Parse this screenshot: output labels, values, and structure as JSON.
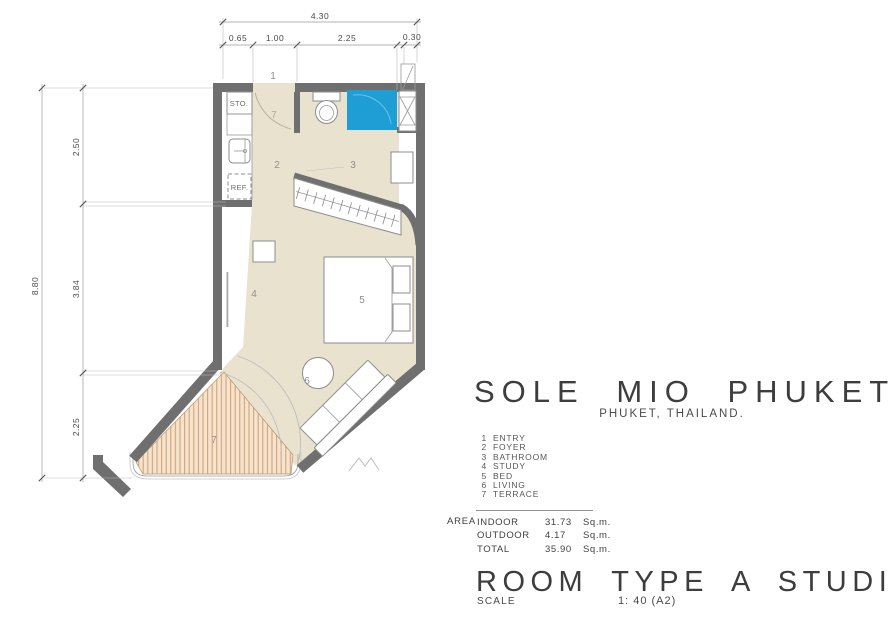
{
  "title": "SOLE MIO PHUKET",
  "subtitle": "PHUKET, THAILAND.",
  "legend": [
    {
      "num": "1",
      "label": "ENTRY"
    },
    {
      "num": "2",
      "label": "FOYER"
    },
    {
      "num": "3",
      "label": "BATHROOM"
    },
    {
      "num": "4",
      "label": "STUDY"
    },
    {
      "num": "5",
      "label": "BED"
    },
    {
      "num": "6",
      "label": "LIVING"
    },
    {
      "num": "7",
      "label": "TERRACE"
    }
  ],
  "area": {
    "label": "AREA",
    "rows": [
      {
        "name": "INDOOR",
        "value": "31.73",
        "unit": "Sq.m."
      },
      {
        "name": "OUTDOOR",
        "value": "4.17",
        "unit": "Sq.m."
      },
      {
        "name": "TOTAL",
        "value": "35.90",
        "unit": "Sq.m."
      }
    ]
  },
  "room_type": "ROOM TYPE A STUDIO",
  "scale_label": "SCALE",
  "scale_value": "1: 40 (A2)",
  "dims": {
    "top_total": "4.30",
    "top_segments": [
      "0.65",
      "1.00",
      "2.25",
      "0.30"
    ],
    "left_total": "8.80",
    "left_segments": [
      "2.50",
      "3.84",
      "2.25"
    ]
  },
  "rooms": {
    "entry": "1",
    "entry_swing": "7",
    "foyer": "2",
    "bathroom": "3",
    "study": "4",
    "bed": "5",
    "living": "6",
    "terrace": "7"
  },
  "fixtures": {
    "storage": "STO.",
    "fridge": "REF."
  },
  "colors": {
    "wall": "#6f6f6f",
    "floor": "#e9e2cf",
    "deck": "#f7e3cb",
    "deck_stripe": "#c99f78",
    "shower": "#1f9ed6",
    "text": "#3d3d3d"
  }
}
